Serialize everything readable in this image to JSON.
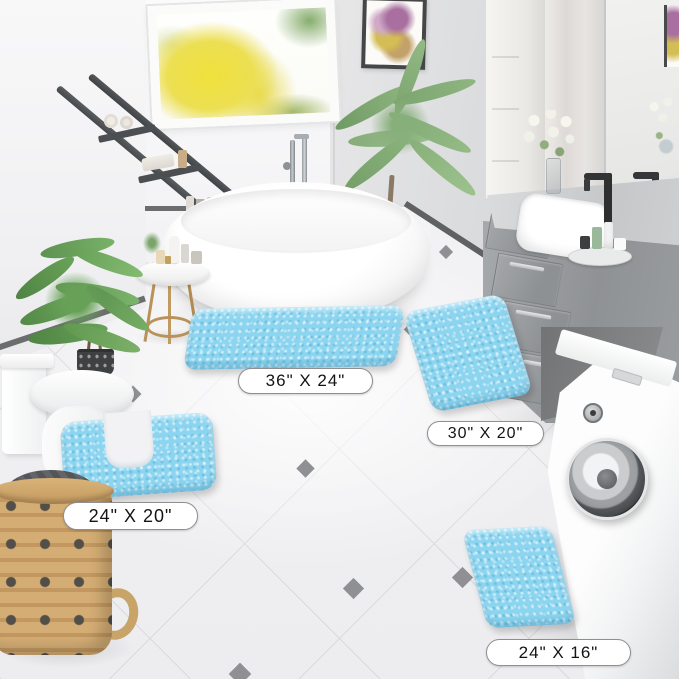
{
  "rug_set": {
    "color_hex": "#8CD5F0",
    "rugs": [
      {
        "id": "rug-36x24",
        "size_label": "36\" X 24\"",
        "shape": "rectangle"
      },
      {
        "id": "rug-30x20",
        "size_label": "30\" X 20\"",
        "shape": "rectangle"
      },
      {
        "id": "rug-24x20-contour",
        "size_label": "24\" X 20\"",
        "shape": "contour"
      },
      {
        "id": "rug-24x16",
        "size_label": "24\" X 16\"",
        "shape": "rectangle"
      }
    ]
  },
  "palette": {
    "rug_blue": "#8CD5F0",
    "floor_white": "#F1F1F3",
    "wall_gray": "#D8D9DB",
    "vanity_gray": "#9A9DA0",
    "trim_dark_gray": "#6B6D6F",
    "window_foliage_yellow": "#EFE04A",
    "plant_green": "#6FA05F",
    "basket_tan": "#C9A36C"
  }
}
